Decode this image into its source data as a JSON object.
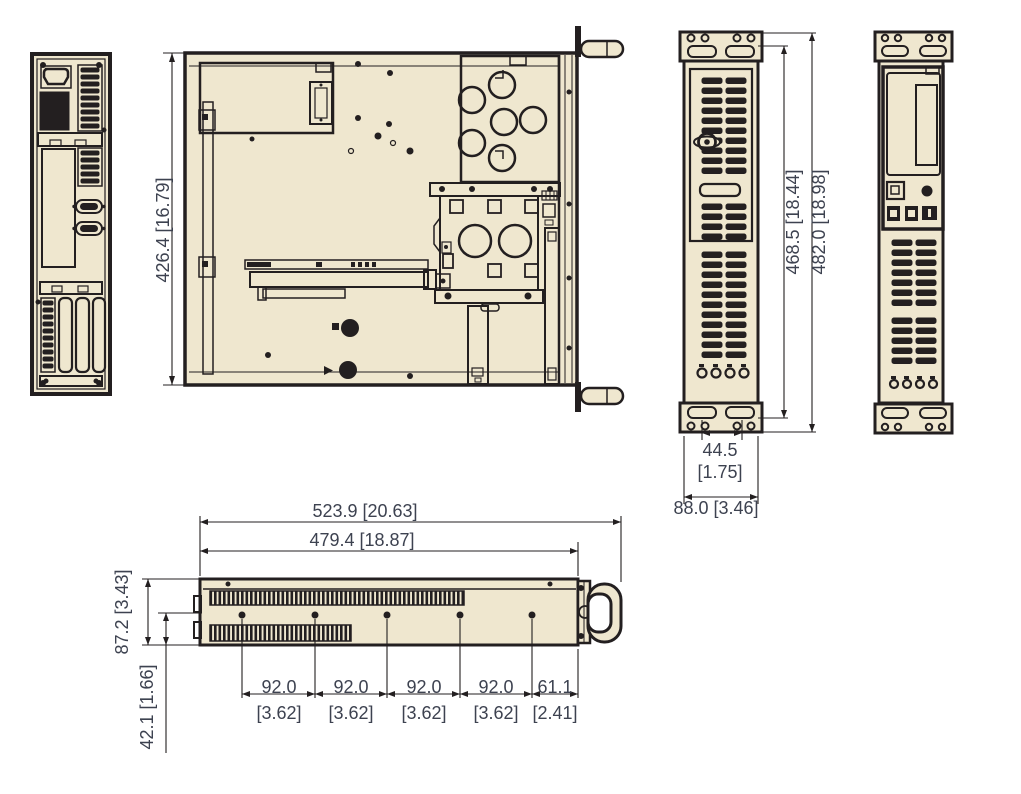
{
  "colors": {
    "background": "#ffffff",
    "chassis_fill": "#efe7cf",
    "line_dark": "#231f20",
    "dimension_text": "#3d4250"
  },
  "dimensions": {
    "top_view": {
      "depth": "426.4 [16.79]"
    },
    "front_view": {
      "rack_opening_height": "468.5 [18.44]",
      "overall_height": "482.0 [18.98]",
      "ear_hole_span_mm": "44.5",
      "ear_hole_span_in": "[1.75]",
      "body_width": "88.0 [3.46]"
    },
    "side_view": {
      "overall_length": "523.9 [20.63]",
      "body_length": "479.4 [18.87]",
      "height": "87.2 [3.43]",
      "hole_line_offset": "42.1 [1.66]",
      "hole_spacings_mm": [
        "92.0",
        "92.0",
        "92.0",
        "92.0",
        "61.1"
      ],
      "hole_spacings_in": [
        "[3.62]",
        "[3.62]",
        "[3.62]",
        "[3.62]",
        "[2.41]"
      ]
    }
  }
}
